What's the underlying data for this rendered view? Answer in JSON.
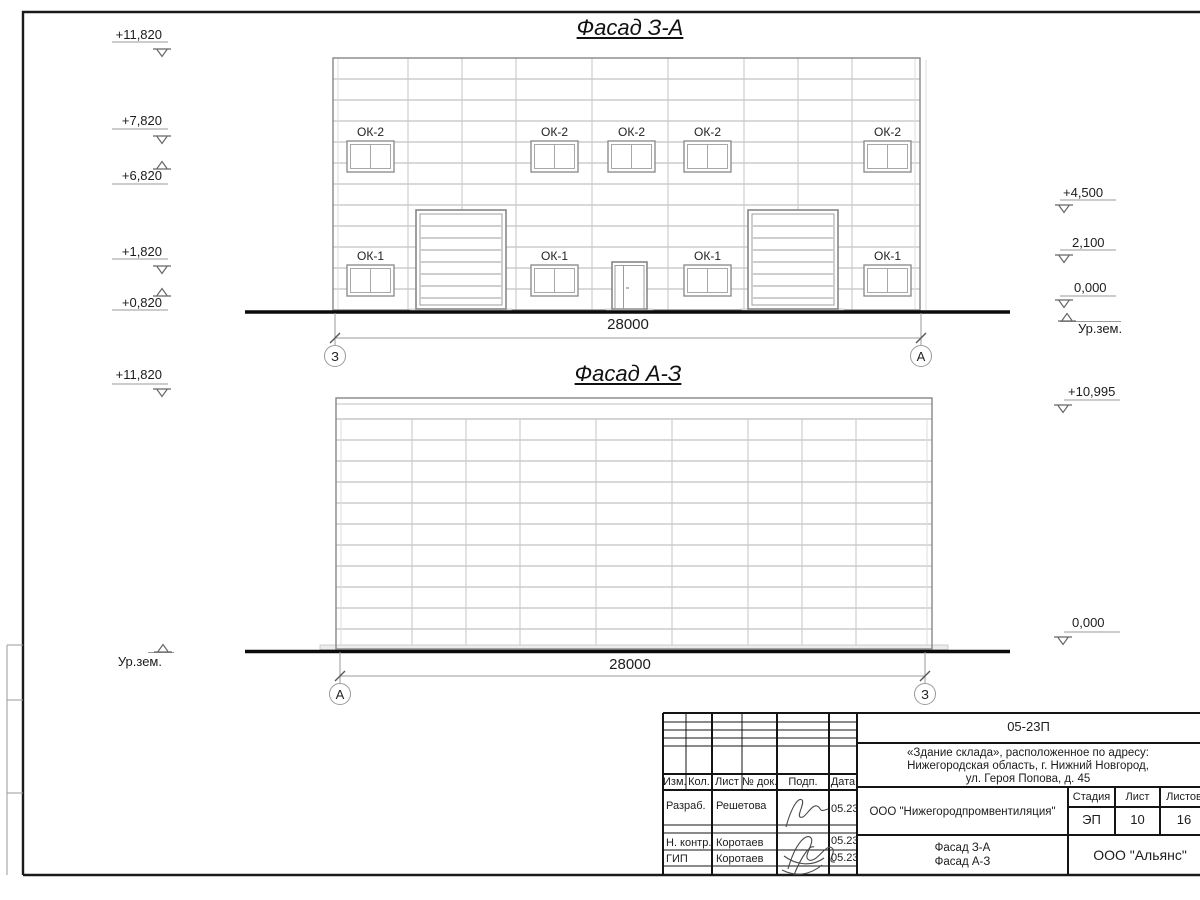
{
  "drawing": {
    "facade1": {
      "title": "Фасад З-А",
      "dimension": "28000",
      "axis_left": "З",
      "axis_right": "А",
      "window_label_upper": "ОК-2",
      "window_label_lower": "ОК-1",
      "elev_left": [
        {
          "v": "+11,820"
        },
        {
          "v": "+7,820"
        },
        {
          "v": "+6,820"
        },
        {
          "v": "+1,820"
        },
        {
          "v": "+0,820"
        }
      ],
      "elev_right": [
        {
          "v": "+4,500"
        },
        {
          "v": "2,100"
        },
        {
          "v": "0,000"
        }
      ],
      "ground_label": "Ур.зем."
    },
    "facade2": {
      "title": "Фасад А-З",
      "dimension": "28000",
      "axis_left": "А",
      "axis_right": "З",
      "elev_left_top": "+11,820",
      "ground_label": "Ур.зем.",
      "elev_right_top": "+10,995",
      "elev_right_bottom": "0,000"
    },
    "title_block": {
      "code": "05-23П",
      "address": [
        "«Здание склада», расположенное по адресу:",
        "Нижегородская область, г. Нижний Новгород,",
        "ул. Героя Попова, д. 45"
      ],
      "header_cols": [
        "Изм.",
        "Кол.",
        "Лист",
        "№ док.",
        "Подп.",
        "Дата"
      ],
      "sign_rows": [
        {
          "role": "Разраб.",
          "name": "Решетова",
          "date": "05.23"
        },
        {
          "role": "Н. контр.",
          "name": "Коротаев",
          "date": "05.23"
        },
        {
          "role": "ГИП",
          "name": "Коротаев",
          "date": "05.23"
        }
      ],
      "organization": "ООО \"Нижегородпромвентиляция\"",
      "stage_label": "Стадия",
      "sheet_label": "Лист",
      "sheets_label": "Листов",
      "stage": "ЭП",
      "sheet_num": "10",
      "sheets_total": "16",
      "drawing_titles": [
        "Фасад З-А",
        "Фасад А-З"
      ],
      "company": "ООО \"Альянс\""
    }
  }
}
